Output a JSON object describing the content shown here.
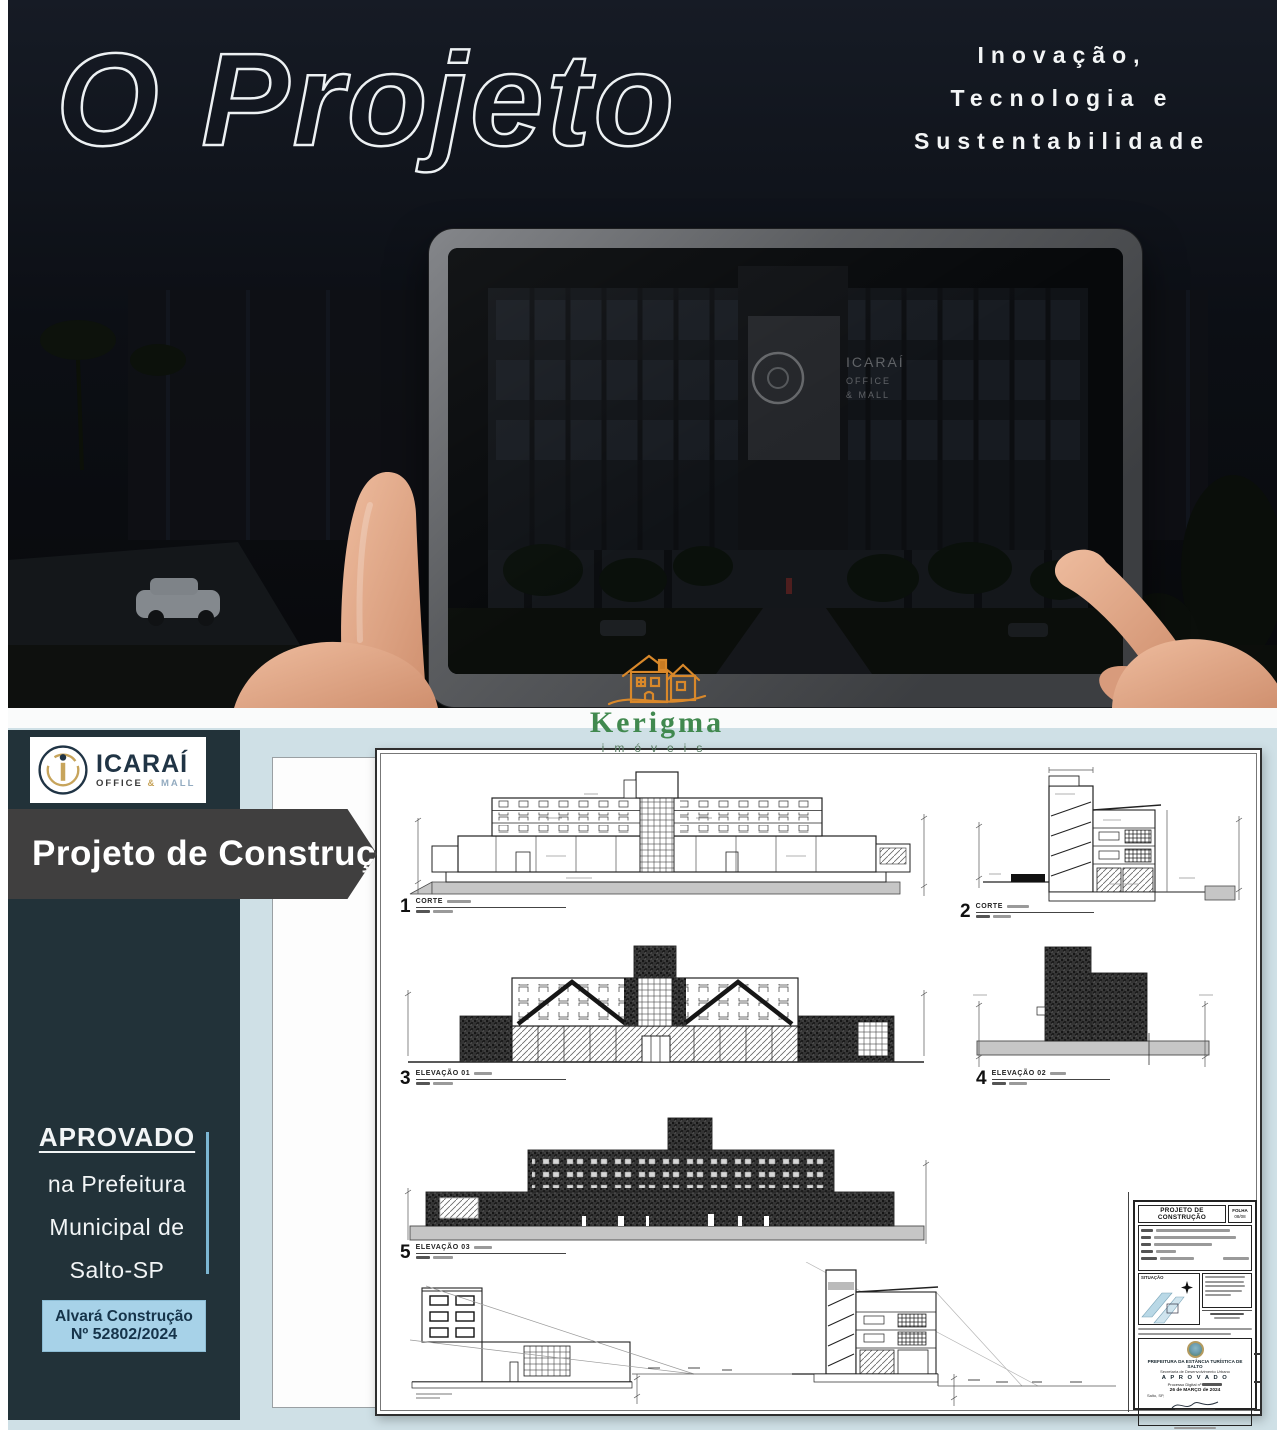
{
  "hero": {
    "title": "O Projeto",
    "tagline": [
      "Inovação,",
      "Tecnologia e",
      "Sustentabilidade"
    ],
    "signage": {
      "brand": "ICARAÍ",
      "line2": "OFFICE",
      "line3": "& MALL"
    }
  },
  "watermark": {
    "name": "Kerigma",
    "tagline": "imóveis"
  },
  "sidebar": {
    "logo": {
      "name": "ICARAÍ",
      "office": "OFFICE",
      "amp": "&",
      "mall": "MALL"
    },
    "banner": "Projeto de Construção",
    "approval": {
      "headline": "APROVADO",
      "lines": [
        "na Prefeitura",
        "Municipal de",
        "Salto-SP"
      ]
    },
    "badge": {
      "line1": "Alvará Construção",
      "line2": "Nº 52802/2024"
    }
  },
  "sheet": {
    "drawings": [
      {
        "num": "1",
        "label": "CORTE"
      },
      {
        "num": "2",
        "label": "CORTE"
      },
      {
        "num": "3",
        "label": "ELEVAÇÃO 01"
      },
      {
        "num": "4",
        "label": "ELEVAÇÃO 02"
      },
      {
        "num": "5",
        "label": "ELEVAÇÃO 03"
      }
    ],
    "title_block": {
      "title": "PROJETO DE CONSTRUÇÃO",
      "folha_label": "FOLHA",
      "folha_value": "08/08",
      "situacao": "SITUAÇÃO",
      "stamp": {
        "org": "PREFEITURA DA ESTÂNCIA TURÍSTICA DE SALTO",
        "dept": "Secretaria de Desenvolvimento Urbano",
        "status": "A P R O V A D O",
        "process": "Processo Digital nº",
        "date": "26 de MARÇO de 2024",
        "city": "Salto, SP,"
      }
    }
  }
}
